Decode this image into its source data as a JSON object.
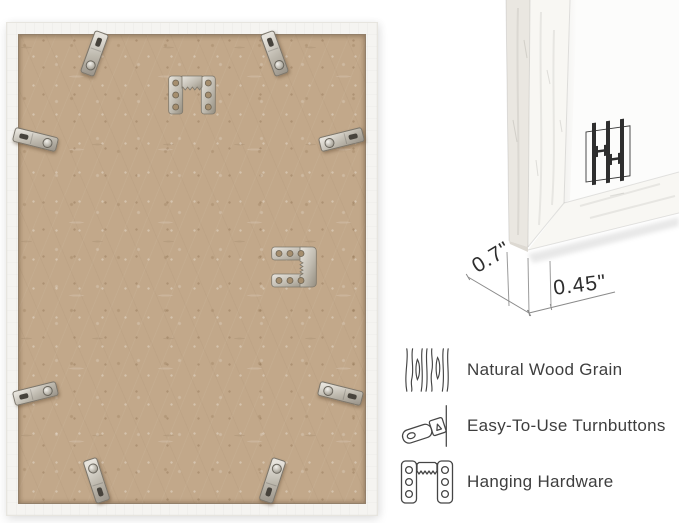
{
  "dimensions": {
    "front_width": "0.7\"",
    "side_depth": "0.45\""
  },
  "features": [
    {
      "icon": "wood-grain-icon",
      "label": "Natural Wood Grain"
    },
    {
      "icon": "turnbutton-icon",
      "label": "Easy-To-Use Turnbuttons"
    },
    {
      "icon": "hanging-hardware-icon",
      "label": "Hanging Hardware"
    }
  ],
  "left_photo": {
    "subject": "frame-back",
    "turnbutton_count": 8,
    "sawtooth_hanger_count": 2
  },
  "corner_photo": {
    "subject": "frame-corner-front",
    "logo": "brand-logo-monogram"
  },
  "colors": {
    "background": "#ffffff",
    "frame_white": "#f5f4f1",
    "backing_tan": "#c2a88a",
    "metal_silver": "#c9c5bc",
    "logo_dark": "#2e2e2e",
    "text_dark": "#3e3e3e",
    "dim_line_gray": "#8a8a8a"
  }
}
